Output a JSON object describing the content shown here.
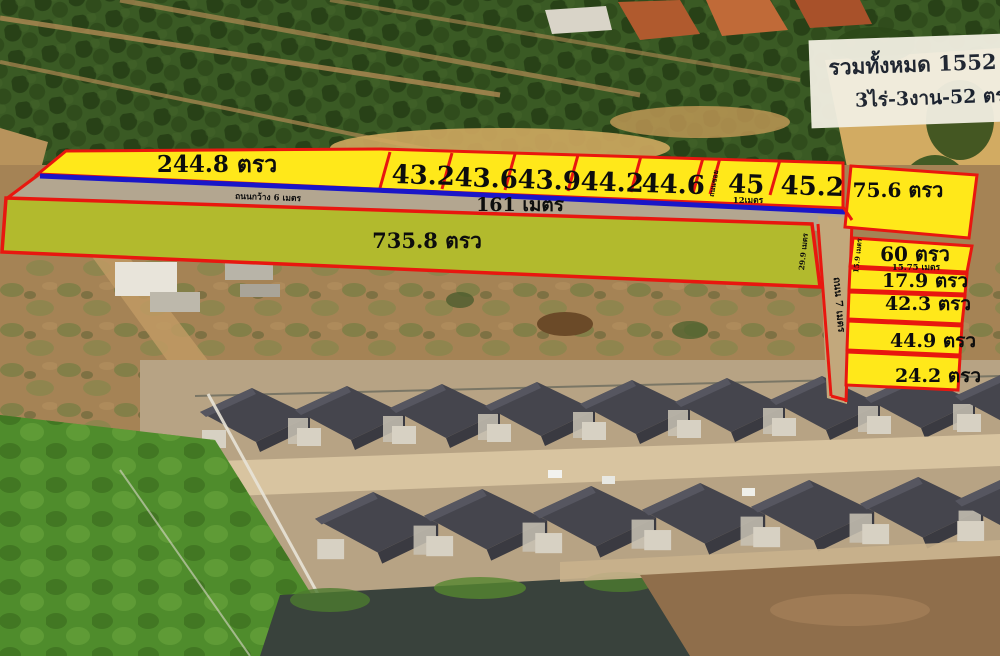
{
  "colors": {
    "plot_fill": "#ffe81a",
    "plot_border": "#e8170f",
    "road_line": "#1a16c8",
    "label_text": "#0d0d0d",
    "summary_bg": "#f2efe2",
    "summary_text": "#182030"
  },
  "summary": {
    "line1": "รวมทั้งหมด 1552 ตรว",
    "line2": "3ไร่-3งาน-52 ตรว"
  },
  "strip": {
    "large_plot": "244.8 ตรว",
    "plots": [
      "43.2",
      "43.6",
      "43.9",
      "44.2",
      "44.6",
      "45",
      "45.2"
    ],
    "corner_plot": "75.6 ตรว",
    "soi_label": "ถนนซอย",
    "plot45_width": "12เมตร"
  },
  "road": {
    "length": "161 เมตร",
    "width_note": "ถนนกว้าง 6 เมตร",
    "side_road": "ถนน 7 เมตร"
  },
  "big_plot": {
    "label": "735.8 ตรว",
    "depth": "29.9 เมตร"
  },
  "right_plots": [
    {
      "label": "60 ตรว",
      "width": "15.75 เมตร",
      "side": "15.9 เมตร"
    },
    {
      "label": "17.9 ตรว"
    },
    {
      "label": "42.3 ตรว"
    },
    {
      "label": "44.9 ตรว"
    },
    {
      "label": "24.2 ตรว"
    }
  ]
}
